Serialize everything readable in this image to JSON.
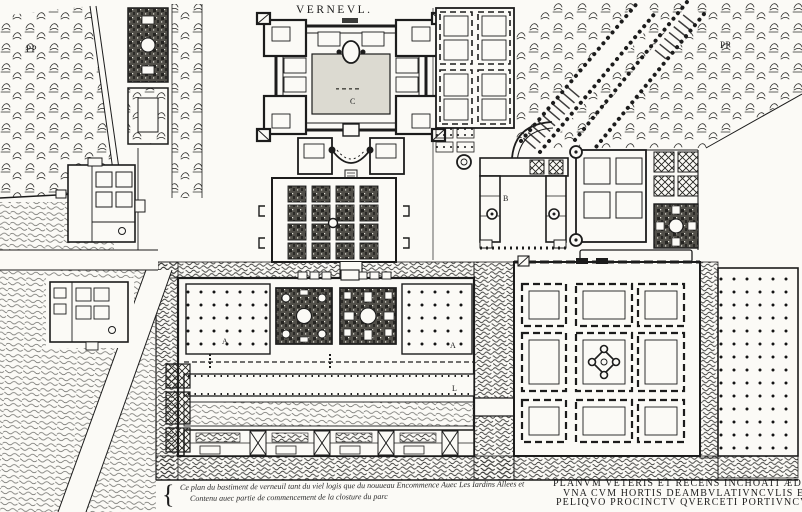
{
  "plan": {
    "title": "VERNEVL.",
    "plan_labels": {
      "park_upper_left": "PP",
      "park_upper_right": "PP",
      "court_letter": "C",
      "service_building_letter": "B",
      "parterre_left_letter": "A",
      "parterre_right_letter": "A",
      "walkway_letter": "L"
    },
    "caption_french": {
      "brace": "{",
      "line1": "Ce plan du bastiment de verneuil tant du viel logis que du nouueau Encommence Auec Les Iardins Allees et",
      "line2": "Contenu auec partie de commencement de la closture du parc"
    },
    "caption_latin": {
      "line1": "PLANVM VETERIS ET RECENS INCHOATI ÆDIFICII",
      "line2": "VNA CVM HORTIS DEAMBVLATIVNCVLIS ET TOTO",
      "line3": "PELIQVO PROCINCTV QVERCETI PORTIVNCVLA"
    },
    "colors": {
      "ink": "#1c1c1c",
      "paper": "#fbfaf6"
    }
  }
}
